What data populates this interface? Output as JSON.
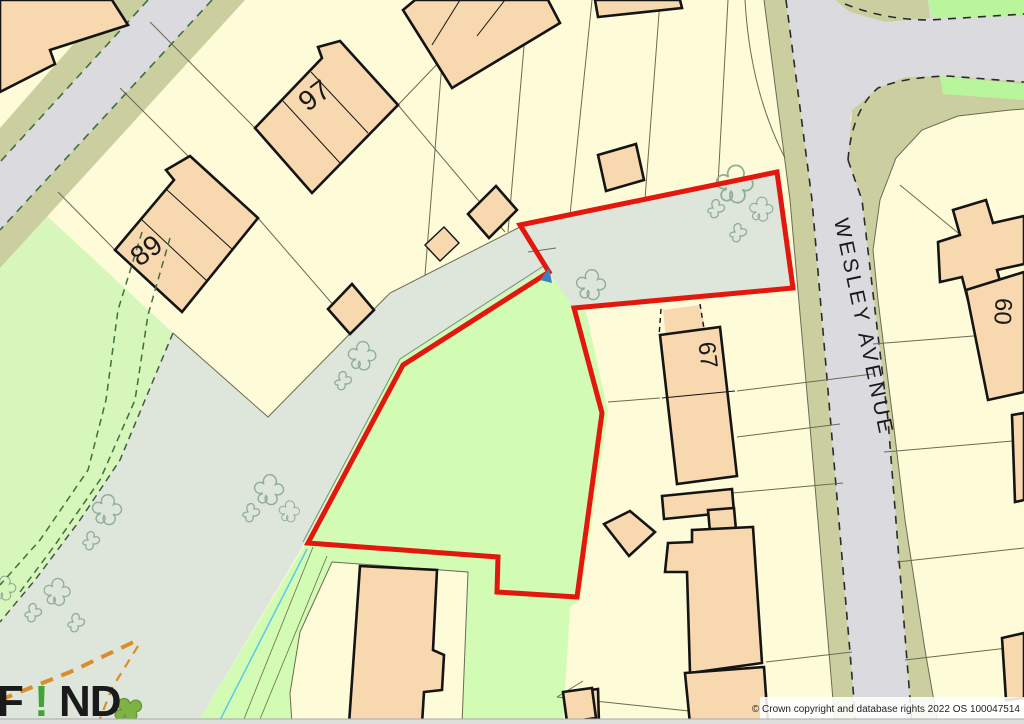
{
  "map": {
    "street_label": "WESLEY AVENUE",
    "house_numbers": {
      "h97": "97",
      "h89": "89",
      "h67": "67",
      "h60": "60"
    },
    "logo": {
      "part1": "F",
      "accent": "!",
      "part2": "ND"
    },
    "attribution": "© Crown copyright and database rights 2022 OS 100047514",
    "colors": {
      "parcel_cream": "#FDFBD8",
      "building_peach": "#F8D8AE",
      "building_outline": "#141414",
      "road_gray": "#DBDADE",
      "verge_khaki": "#CBCFA0",
      "open_sage": "#DEE5DA",
      "site_field_green": "#D2FBB4",
      "amenity_green": "#D7F6BC",
      "roadside_green": "#B9F69B",
      "site_boundary_red": "#E2170D",
      "stream_cyan": "#58CBE8",
      "path_orange": "#D98E2B",
      "footpath_green_dash": "#3E6F41",
      "parcel_line_olive": "#6B6B52",
      "tree_outline": "#8FAE94",
      "logo_accent_green": "#3FA535"
    }
  }
}
